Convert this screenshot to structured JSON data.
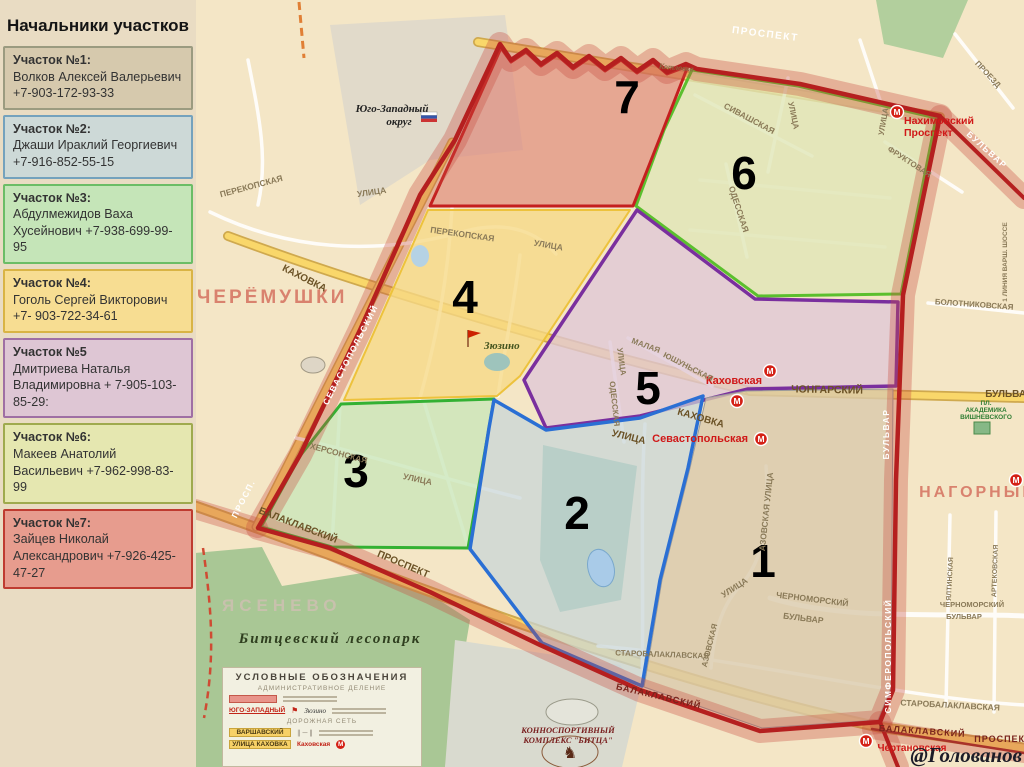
{
  "panel": {
    "title": "Начальники участков",
    "sections": [
      {
        "label": "Участок №1:",
        "name": "Волков Алексей Валерьевич",
        "phone": "+7-903-172-93-33",
        "fill": "#d6c9ad",
        "border": "#9b9b80"
      },
      {
        "label": "Участок №2:",
        "name": "Джаши Ираклий Георгиевич",
        "phone": "+7-916-852-55-15",
        "fill": "#cdd9d7",
        "border": "#74a2bd"
      },
      {
        "label": "Участок №3:",
        "name": "Абдулмежидов Ваха Хусейнович",
        "phone": "+7-938-699-99-95",
        "fill": "#c5e5b8",
        "border": "#6bbd66"
      },
      {
        "label": "Участок №4:",
        "name": "Гоголь Сергей Викторович",
        "phone": "+7- 903-722-34-61",
        "fill": "#f7dd92",
        "border": "#d9b445"
      },
      {
        "label": "Участок №5",
        "name": "Дмитриева Наталья Владимировна",
        "phone": "+ 7-905-103-85-29:",
        "fill": "#dec6d4",
        "border": "#9f6fa4"
      },
      {
        "label": "Участок №6:",
        "name": "Макеев Анатолий Васильевич",
        "phone": "+7-962-998-83-99",
        "fill": "#e5e7b0",
        "border": "#9faa4e"
      },
      {
        "label": "Участок №7:",
        "name": "Зайцев Николай Александрович",
        "phone": "+7-926-425-47-27",
        "fill": "#e79c8e",
        "border": "#bf3b30"
      }
    ]
  },
  "map": {
    "metro_letter": "М",
    "boundary_color": "#b51f1f",
    "districts": [
      {
        "number": "1",
        "fill": "#d9c9ab",
        "border": "#9a9a9a"
      },
      {
        "number": "2",
        "fill": "#c8d6d8",
        "border": "#2a6fd4"
      },
      {
        "number": "3",
        "fill": "#c9e6b9",
        "border": "#33b133"
      },
      {
        "number": "4",
        "fill": "#f6d985",
        "border": "#edc23c"
      },
      {
        "number": "5",
        "fill": "#dfc7d6",
        "border": "#7a2f9e"
      },
      {
        "number": "6",
        "fill": "#dfe6b6",
        "border": "#5bbf2e"
      },
      {
        "number": "7",
        "fill": "#dd7f72",
        "border": "#c41f1f"
      }
    ],
    "labels": {
      "prospekt_top": "ПРОСПЕКТ",
      "kotlovka": "Котловка",
      "metro_nah1": "Нахимовский",
      "metro_nah2": "Проспект",
      "fruktovaya": "ФРУКТОВАЯ",
      "ulitsa_nah": "УЛИЦА",
      "proezd": "ПРОЕЗД",
      "bulvar_ext": "БУЛЬВАР",
      "bolotnikovskaya": "БОЛОТНИКОВСКАЯ",
      "linia_varsh": "1 ЛИНИЯ ВАРШ. ШОССЕ",
      "sivashskaya": "СИВАШСКАЯ",
      "ulitsa_siv": "УЛИЦА",
      "odesskaya6": "ОДЕССКАЯ",
      "perekop_w": "ПЕРЕКОПСКАЯ",
      "ulitsa_w": "УЛИЦА",
      "perekop4": "ПЕРЕКОПСКАЯ",
      "ulitsa4": "УЛИЦА",
      "zuzino": "Зюзино",
      "ygo1": "Юго-Западный",
      "ygo2": "округ",
      "cheryomushki": "ЧЕРЁМУШКИ",
      "kahovka_w": "КАХОВКА",
      "kahovka_e": "КАХОВКА",
      "ulitsa_kah": "УЛИЦА",
      "chongarsky": "ЧОНГАРСКИЙ",
      "bulvar_r": "БУЛЬВАР",
      "m_kah": "Каховская",
      "m_sev": "Севастопольская",
      "malaya": "МАЛАЯ",
      "yushunskaya": "ЮШУНЬСКАЯ",
      "ulitsa5": "УЛИЦА",
      "odesskaya5": "ОДЕССКАЯ",
      "hersonskaya": "ХЕРСОНСКАЯ",
      "ulitsa3": "УЛИЦА",
      "balaklavsky_w": "БАЛАКЛАВСКИЙ",
      "prospekt_w": "ПРОСПЕКТ",
      "yasenevo": "ЯСЕНЕВО",
      "bitsevsky": "Битцевский  лесопарк",
      "konno1": "КОННОСПОРТИВНЫЙ",
      "konno2": "КОМПЛЕКС \"БИТЦА\"",
      "starob1": "СТАРОБАЛАКЛАВСКАЯ",
      "starob2": "СТАРОБАЛАКЛАВСКАЯ",
      "balaklavsky_s": "БАЛАКЛАВСКИЙ",
      "balaklavsky_s2": "БАЛАКЛАВСКИЙ",
      "prospekt_s": "ПРОСПЕКТ",
      "m_chert": "Чертановская",
      "azovskaya": "АЗОВСКАЯ УЛИЦА",
      "ulitsa1": "УЛИЦА",
      "azov2": "АЗОВСКАЯ",
      "chernomorsky1": "ЧЕРНОМОРСКИЙ",
      "bulvar1": "БУЛЬВАР",
      "chern_r": "ЧЕРНОМОРСКИЙ",
      "bulvar_r2": "БУЛЬВАР",
      "nagorny": "НАГОРНЫЙ",
      "pl1": "ПЛ.",
      "pl2": "АКАДЕМИКА",
      "pl3": "ВИШНЕВСКОГО",
      "yaltinskaya": "ЯЛТИНСКАЯ",
      "artekovskaya": "АРТЕКОВСКАЯ",
      "simferopolsky": "СИМФЕРОПОЛЬСКИЙ",
      "bulvar_vert": "БУЛЬВАР",
      "sevast_band": "СЕВАСТОПОЛЬСКИЙ",
      "prosp_band": "ПРОСП."
    },
    "watermark": "@Голованов"
  },
  "legend_box": {
    "title": "УСЛОВНЫЕ ОБОЗНАЧЕНИЯ",
    "section1": "АДМИНИСТРАТИВНОЕ ДЕЛЕНИЕ",
    "district_name": "ЮГО-ЗАПАДНЫЙ",
    "settlement": "Зюзино",
    "section2": "ДОРОЖНАЯ СЕТЬ",
    "road_major": "ВАРШАВСКИЙ",
    "road_street": "УЛИЦА  КАХОВКА",
    "metro_name": "Каховская",
    "metro_letter": "М"
  }
}
